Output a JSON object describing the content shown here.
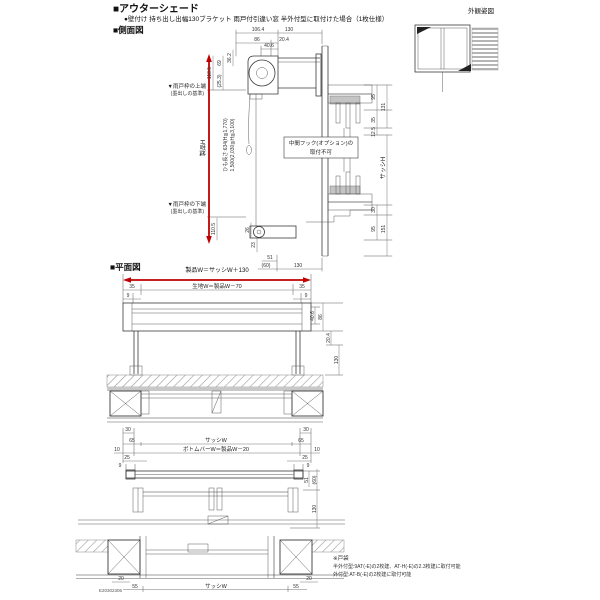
{
  "header": {
    "title": "■アウターシェード",
    "subtitle": "●壁付け 持ち出し出幅130ブラケット 雨戸付引違い窓 半外付型に取付けた場合（1枚仕様）",
    "side_view_title": "■側面図",
    "plan_view_title": "■平面図",
    "appearance_title": "外観姿図"
  },
  "colors": {
    "arrow": "#c00000",
    "line": "#3a3a3a",
    "gray_fill": "#c4c4c4"
  },
  "side_view": {
    "top_dims": {
      "total": "106.4",
      "right": "130",
      "a": "86",
      "b": "20.4",
      "box": "40.6"
    },
    "left_dims": {
      "h1": "118.5",
      "h2": "69",
      "h3": "(25.3)",
      "h4": "36.2",
      "bottom": "110.5"
    },
    "right_dims": {
      "r1": "95",
      "r2": "131",
      "r3": "35",
      "r4": "12.5",
      "r5": "30",
      "r6": "151",
      "r7": "95"
    },
    "bottom_dims": {
      "b1": "26",
      "b2": "23",
      "b3": "51",
      "b4": "(60)",
      "b5": "130"
    },
    "labels": {
      "product_height": "製品H",
      "sash_height": "サッシH",
      "cord_line1": "ひも長さ:634(H≦1,770)",
      "cord_line2": "1,500(2,030≦H≦3,100)",
      "upper_datum1": "▼雨戸枠の上端",
      "upper_datum2": "(墨出しの基準)",
      "lower_datum1": "▼雨戸枠の下端",
      "lower_datum2": "(墨出しの基準)",
      "hook_line1": "中間フック(オプション)の",
      "hook_line2": "取付不可"
    }
  },
  "plan_view": {
    "width_dims": {
      "product": "製品W＝サッシW＋130",
      "fabric": "生地W＝製品W－70",
      "end35": "35",
      "end9": "9",
      "d30": "30",
      "d65": "65",
      "sash_w": "サッシW",
      "bottom_bar": "ボトムバーW＝製品W－20",
      "d10": "10",
      "d25": "25",
      "bar9": "9",
      "d20": "20",
      "d55": "55",
      "sash_w2": "サッシW"
    },
    "right_dims": {
      "r1": "40.6",
      "r2": "86",
      "r3": "20.4",
      "r4": "130",
      "r5": "51",
      "r6": "(60)",
      "r7": "130"
    }
  },
  "notes": {
    "line1": "※戸袋",
    "line2": "半外付型:9AT(-E)の2枚建、AT-H(-E)の2.3枚建に取付可能",
    "line3": "外付型:AT-B(-E)の2枚建に取付可能"
  },
  "doc_number": "E20302306"
}
